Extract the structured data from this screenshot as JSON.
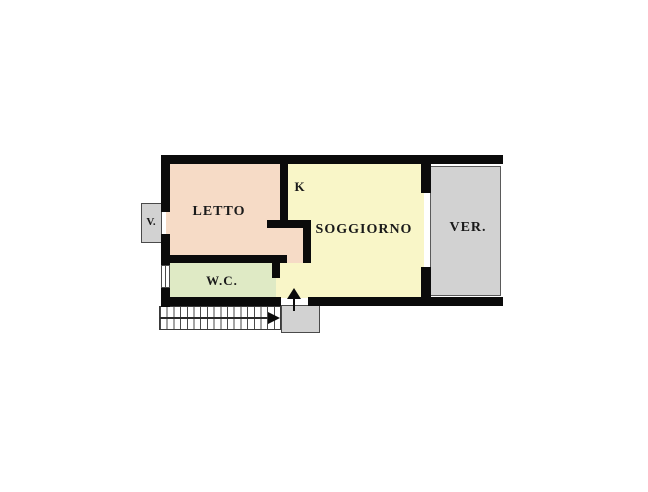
{
  "plan": {
    "type": "apartment-floor-plan",
    "rooms": {
      "letto": {
        "label": "LETTO"
      },
      "kitchen": {
        "label": "K"
      },
      "soggiorno": {
        "label": "SOGGIORNO"
      },
      "veranda": {
        "label": "VER."
      },
      "wc": {
        "label": "W.C."
      },
      "balcony": {
        "label": "V."
      }
    },
    "icons": {
      "entrance_arrow": "up-arrow-entrance",
      "stairs_arrow": "right-arrow-stairs-direction",
      "window": "window-symbol"
    },
    "colors": {
      "bedroom_fill": "#f6dbc6",
      "living_fill": "#f9f6c8",
      "wc_fill": "#dfeac5",
      "outdoor_fill": "#d2d2d2",
      "wall": "#0b0b0b",
      "background": "#ffffff"
    }
  }
}
